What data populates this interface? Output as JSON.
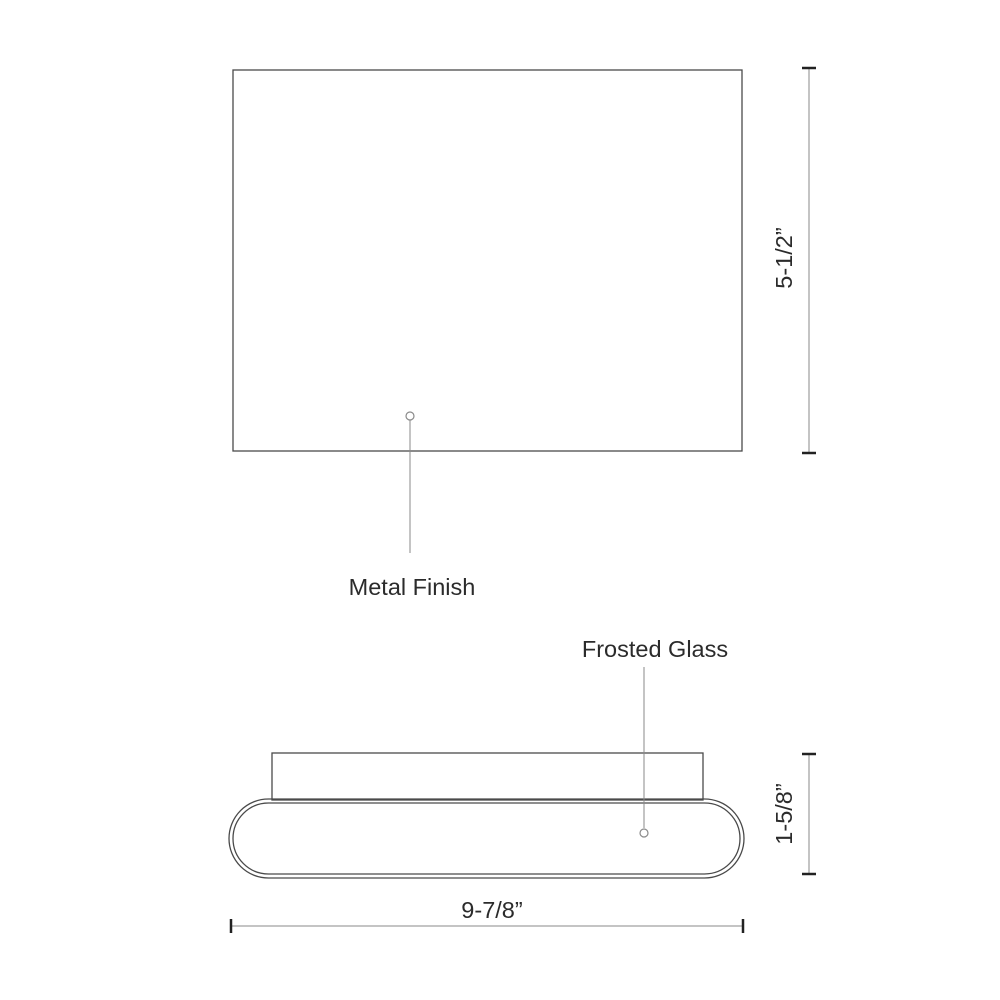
{
  "drawing": {
    "type": "technical-dimension-diagram",
    "labels": {
      "metal_finish": "Metal Finish",
      "frosted_glass": "Frosted Glass"
    },
    "dimensions": {
      "front_height": "5-1/2”",
      "side_depth": "1-5/8”",
      "side_width": "9-7/8”"
    }
  },
  "colors": {
    "background": "#ffffff",
    "object_line": "#4a4a4a",
    "dim_line": "#8a8a8a",
    "tick": "#222222",
    "text": "#2b2b2b"
  }
}
